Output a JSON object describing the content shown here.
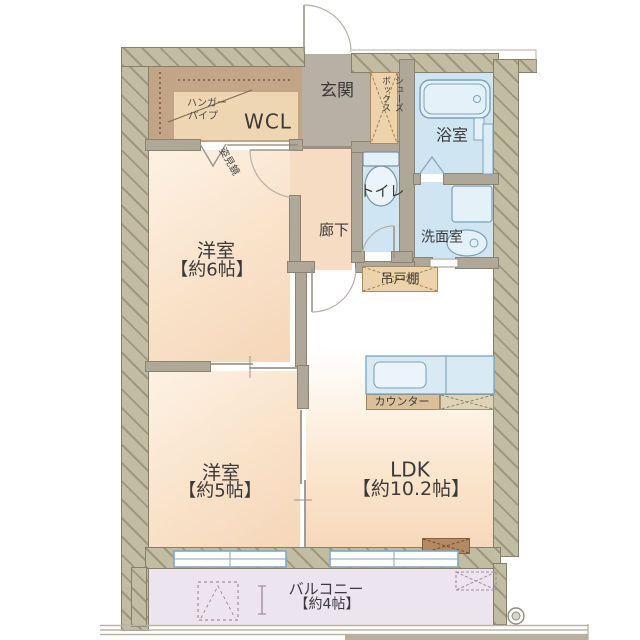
{
  "plan_title": "2LDK apartment floor plan",
  "labels": {
    "wcl": "WCL",
    "hanger_line1": "ハンガー",
    "hanger_line2": "パイプ",
    "mirror": "姿見鏡",
    "genkan": "玄関",
    "shoes_line1": "シューズ",
    "shoes_line2": "ボックス",
    "bathroom": "浴室",
    "toilet": "トイレ",
    "hallway": "廊下",
    "washroom": "洗面室",
    "hanging_cupboard": "吊戸棚",
    "bedroom6_name": "洋室",
    "bedroom6_size": "【約6帖】",
    "bedroom5_name": "洋室",
    "bedroom5_size": "【約5帖】",
    "ldk_name": "LDK",
    "ldk_size": "【約10.2帖】",
    "counter": "カウンター",
    "balcony_name": "バルコニー",
    "balcony_size": "【約4帖】"
  },
  "colors": {
    "outer_wall": "#c2bca3",
    "inner_wall": "#afa899",
    "room_floor_peach": "#f9e2c9",
    "entrance_gray": "#b8afa5",
    "wet_area_blue": "#cfe5f1",
    "fixture_blue_line": "#7aa2bd",
    "closet_brown": "#c2a486",
    "closet_tan": "#eed6b2",
    "cabinet_tan": "#ecd3ab",
    "balcony_lavender": "#ece4ef",
    "label_text": "#3a3a3a",
    "window_frame_blue": "#7fa9c4"
  }
}
